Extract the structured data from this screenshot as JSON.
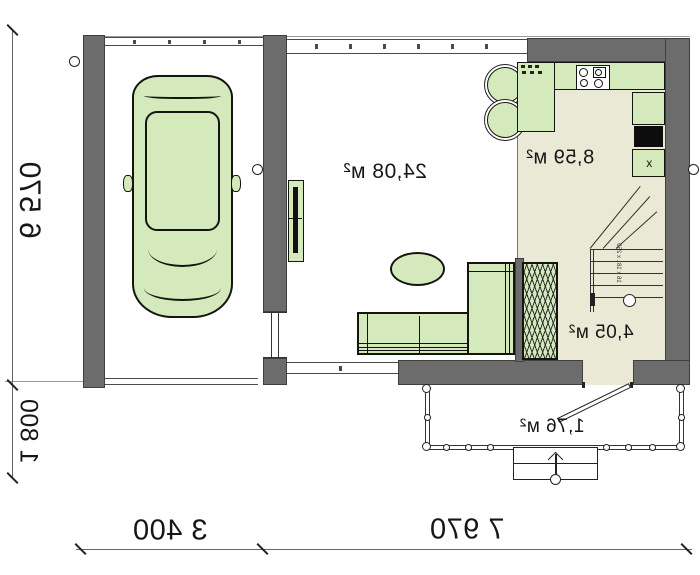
{
  "rooms": {
    "living": {
      "area": "24,08 м²"
    },
    "kitchen": {
      "area": "8,59 м²"
    },
    "hall": {
      "area": "4,05 м²"
    },
    "porch": {
      "area": "1,76 м²"
    }
  },
  "dimensions": {
    "side_total": "6 570",
    "side_porch": "1 800",
    "bottom_garage": "3 400",
    "bottom_house": "7 970"
  },
  "stairs": {
    "note": "16 x 181 x 250"
  },
  "kitchen_marks": {
    "x_cabinet": "x"
  },
  "colors": {
    "wall": "#6c6c6c",
    "floor": "#e9e9d6",
    "furniture": "#d5eabc",
    "line": "#1d1d1b"
  }
}
